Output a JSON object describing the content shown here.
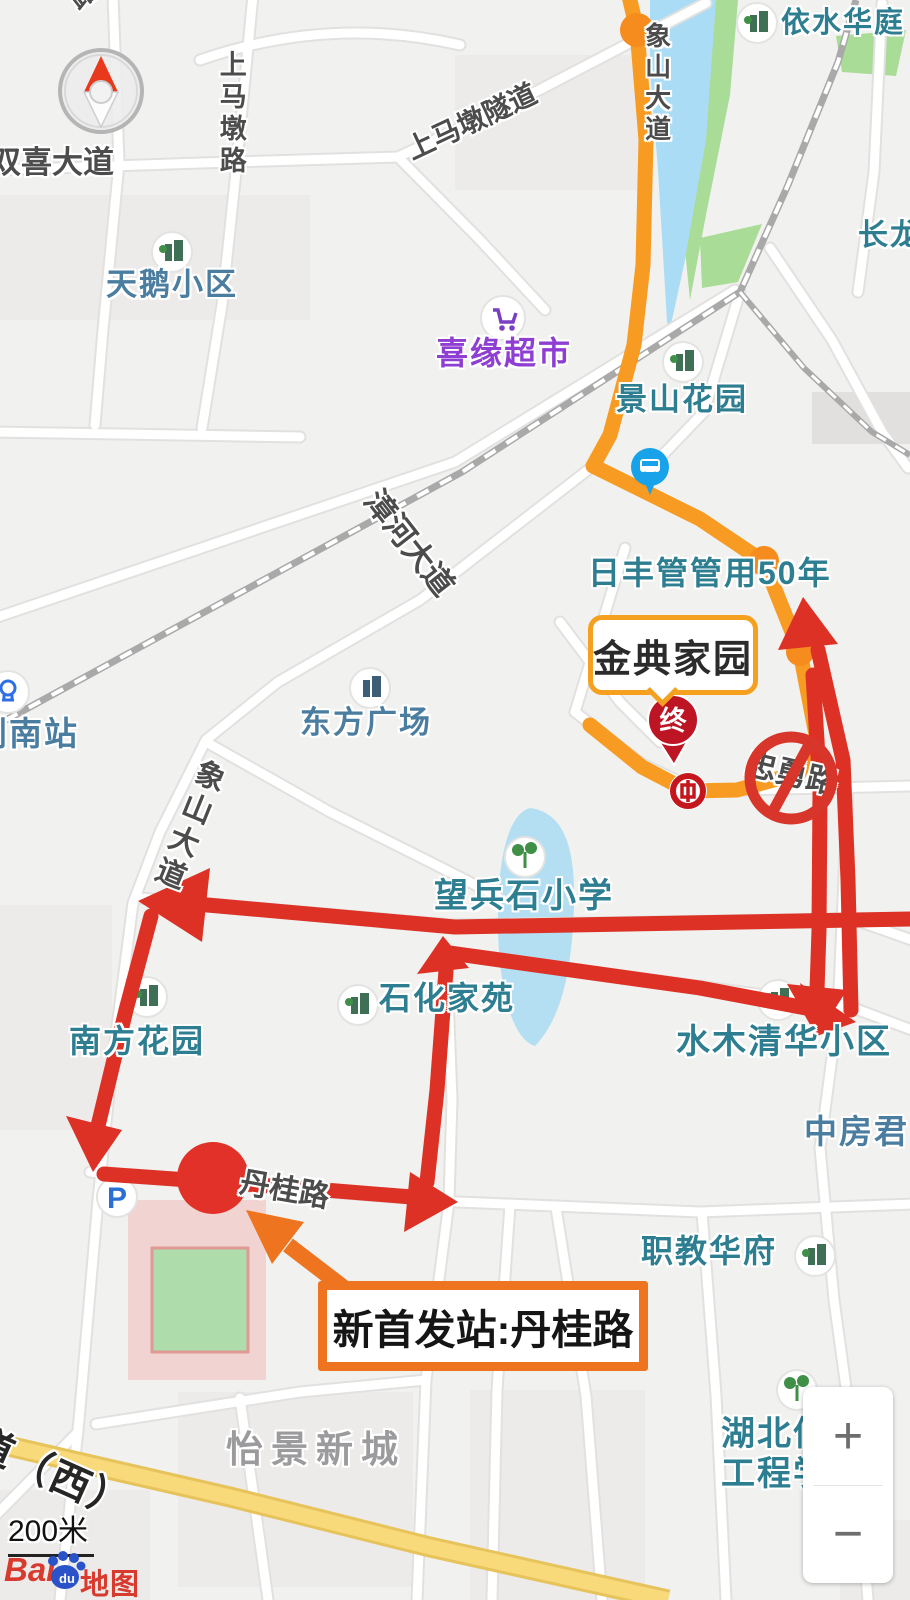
{
  "page": {
    "width": 910,
    "height": 1600,
    "app": "baidu-map"
  },
  "colors": {
    "background": "#f1f1ef",
    "road_fill": "#ffffff",
    "road_casing": "#e2e1df",
    "yellow_road": "#f8da7a",
    "green_area": "#a9dc96",
    "water": "#aadcf5",
    "route_orange": "#f79b22",
    "overlay_red": "#dd3126",
    "annotation_orange": "#ee7420",
    "no_entry_red": "#d8352b",
    "poi_teal": "#2e7e92",
    "pin_red": "#bd1523"
  },
  "annotations": {
    "jindian_label": "金典家园",
    "new_start_label": "新首发站:丹桂路",
    "pin_label": "终"
  },
  "zoom_control": {
    "plus": "+",
    "minus": "−"
  },
  "scale": {
    "label": "200米"
  },
  "logo": {
    "bai": "Bai",
    "du": "du",
    "ditu": "地图"
  },
  "icons": {
    "parking_letter": "P"
  },
  "map_labels": [
    {
      "name": "road-label-top-partial",
      "text": "路",
      "x": 64,
      "y": -8,
      "size": 27,
      "cls": "road",
      "rot": -38
    },
    {
      "name": "road-label-shuangxi-avenue",
      "text": "双喜大道",
      "x": -10,
      "y": 146,
      "size": 31,
      "cls": "road"
    },
    {
      "name": "road-label-shangmadun-road",
      "text": "上马墩路",
      "x": 215,
      "y": 50,
      "size": 27,
      "cls": "road",
      "vert": true
    },
    {
      "name": "road-label-shangmadun-tunnel",
      "text": "上马墩隧道",
      "x": 402,
      "y": 138,
      "size": 28,
      "cls": "road",
      "rot": -25
    },
    {
      "name": "poi-label-yishui-huating",
      "text": "依水华庭",
      "x": 781,
      "y": 8,
      "size": 29,
      "cls": "poi"
    },
    {
      "name": "poi-label-changlong",
      "text": "长龙",
      "x": 858,
      "y": 219,
      "size": 30,
      "cls": "poi"
    },
    {
      "name": "poi-label-tiane-xiaoqu",
      "text": "天鹅小区",
      "x": 106,
      "y": 268,
      "size": 31,
      "cls": "poi-blue"
    },
    {
      "name": "poi-label-xiyuan-supermarket",
      "text": "喜缘超市",
      "x": 436,
      "y": 336,
      "size": 32,
      "cls": "market"
    },
    {
      "name": "poi-label-jingshan-garden",
      "text": "景山花园",
      "x": 616,
      "y": 383,
      "size": 31,
      "cls": "poi"
    },
    {
      "name": "poi-label-rifeng-ad",
      "text": "日丰管管用50年",
      "x": 588,
      "y": 556,
      "size": 32,
      "cls": "poi"
    },
    {
      "name": "road-label-zhanghe-avenue",
      "text": "漳河大道",
      "x": 384,
      "y": 484,
      "size": 31,
      "cls": "road",
      "rot": 52
    },
    {
      "name": "poi-label-dongfang-plaza",
      "text": "东方广场",
      "x": 300,
      "y": 706,
      "size": 31,
      "cls": "poi-blue"
    },
    {
      "name": "poi-label-jingnan-station",
      "text": "荆南站",
      "x": -26,
      "y": 716,
      "size": 33,
      "cls": "poi-blue"
    },
    {
      "name": "road-label-xiangshan-avenue-north",
      "text": "象山大道",
      "x": 642,
      "y": 22,
      "size": 26,
      "cls": "road",
      "vert": true
    },
    {
      "name": "road-label-xiangshan-avenue-south",
      "text": "象山大道",
      "x": 198,
      "y": 754,
      "size": 30,
      "cls": "road",
      "vert": true,
      "rot": 22
    },
    {
      "name": "road-label-zhongyong-road",
      "text": "忠勇路",
      "x": 750,
      "y": 747,
      "size": 31,
      "cls": "road",
      "rot": 13
    },
    {
      "name": "poi-label-wangbingshi-primary-school",
      "text": "望兵石小学",
      "x": 434,
      "y": 878,
      "size": 34,
      "cls": "poi"
    },
    {
      "name": "poi-label-shihua-jiayuan",
      "text": "石化家苑",
      "x": 379,
      "y": 981,
      "size": 32,
      "cls": "poi"
    },
    {
      "name": "poi-label-nanfang-garden",
      "text": "南方花园",
      "x": 69,
      "y": 1024,
      "size": 32,
      "cls": "poi"
    },
    {
      "name": "poi-label-shuimu-qinghua",
      "text": "水木清华小区",
      "x": 676,
      "y": 1024,
      "size": 34,
      "cls": "poi"
    },
    {
      "name": "poi-label-zhongfangjun",
      "text": "中房君",
      "x": 804,
      "y": 1114,
      "size": 33,
      "cls": "poi-blue"
    },
    {
      "name": "poi-label-zhijiao-huafu",
      "text": "职教华府",
      "x": 641,
      "y": 1234,
      "size": 32,
      "cls": "poi"
    },
    {
      "name": "road-label-dangui-road",
      "text": "丹桂路",
      "x": 243,
      "y": 1166,
      "size": 30,
      "cls": "road",
      "rot": 10
    },
    {
      "name": "area-label-yijing-xincheng",
      "text": "怡景新城",
      "x": 226,
      "y": 1430,
      "size": 37,
      "cls": "area"
    },
    {
      "name": "poi-label-hubei-school-line1",
      "text": "湖北信息",
      "x": 721,
      "y": 1416,
      "size": 34,
      "cls": "poi"
    },
    {
      "name": "poi-label-hubei-school-line2",
      "text": "工程学校",
      "x": 721,
      "y": 1456,
      "size": 34,
      "cls": "poi"
    },
    {
      "name": "road-label-dao-xi",
      "text": "道（西）",
      "x": -16,
      "y": 1420,
      "size": 40,
      "cls": "road-big",
      "rot": 24
    }
  ]
}
